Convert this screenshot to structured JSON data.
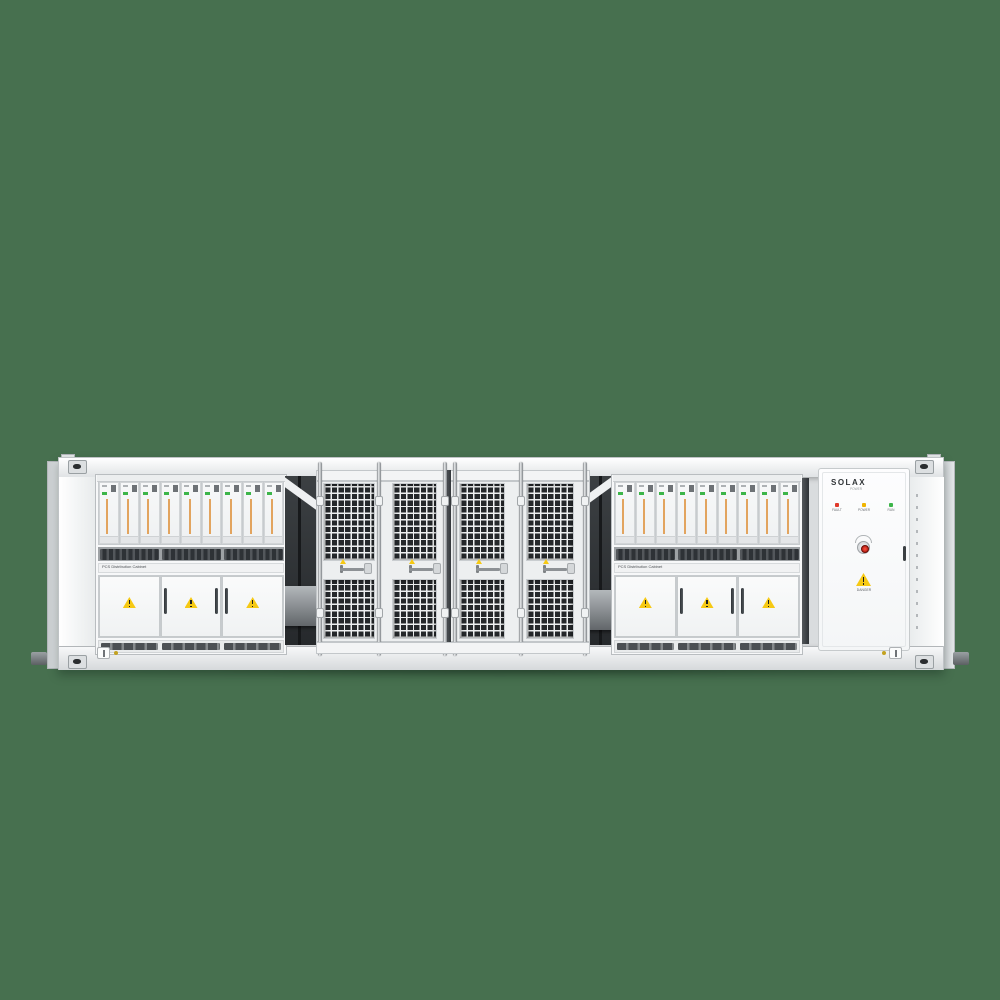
{
  "scene": {
    "type": "product-render",
    "subject": "SolaX containerized battery energy storage system, front elevation",
    "background_color": "#47704f"
  },
  "pcs_rack": {
    "label": "PCS Distribution Cabinet",
    "module_count": 9,
    "door_count": 3,
    "module_stripe_color": "#e2a45f",
    "module_led_color": "#3db54a"
  },
  "cage": {
    "door_count": 4,
    "mesh_color": "#25282b"
  },
  "solax_cabinet": {
    "brand": "SOLAX",
    "brand_sub": "POWER",
    "leds": [
      {
        "label": "FAULT",
        "color": "#e0392b"
      },
      {
        "label": "POWER",
        "color": "#f0b400"
      },
      {
        "label": "RUN",
        "color": "#3db54a"
      }
    ],
    "warning_label": "DANGER"
  },
  "colors": {
    "container_body": "#f2f4f5",
    "warning_yellow": "#f6c914",
    "vent_dark": "#4c5054"
  }
}
